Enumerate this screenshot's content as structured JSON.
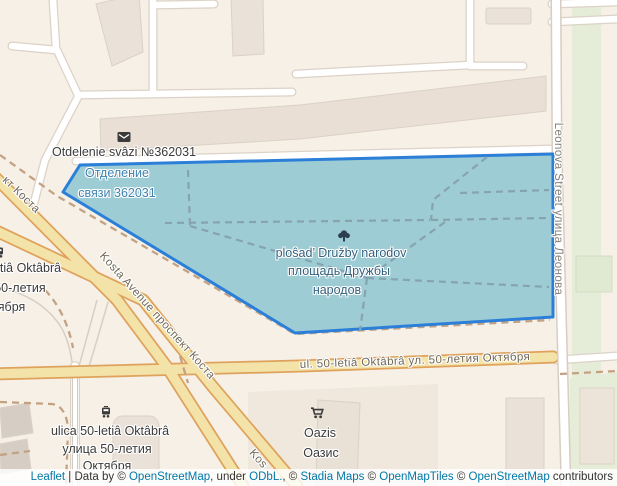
{
  "map_labels": {
    "post_office": {
      "latin": "Otdelenie svâzi №362031",
      "cyr_line1": "Отделение",
      "cyr_line2": "связи 362031"
    },
    "square": {
      "latin": "ploŝad’ Družby narodov",
      "cyr_line1": "площадь Дружбы",
      "cyr_line2": "народов"
    },
    "street_50_letiya": {
      "latin": "ulica 50-letiâ Oktâbrâ",
      "cyr_line1": "улица 50-летия",
      "cyr_line2": "Октября"
    },
    "street_50_letiya_left_cut": {
      "latin": "ulica 50-letiâ Oktâbrâ",
      "cyr_line1": "улица 50-летия",
      "cyr_line2": "Октября"
    },
    "oazis": {
      "latin": "Oazis",
      "cyr": "Оазис"
    }
  },
  "road_labels": {
    "kosta_avenue": "Kosta Avenue проспект Коста",
    "kosta_top_left_cut": "кт Коста",
    "kosta_bottom_cut": "Kos",
    "ulitsa_50_letiya": "ul. 50-letiâ Oktâbrâ ул. 50-летия Октября",
    "leonova": "Leonova Street улица Леонова"
  },
  "attribution": {
    "leaflet_link": "Leaflet",
    "data_by": " | Data by © ",
    "osm_link_1": "OpenStreetMap",
    "under": ", under ",
    "odbl_link": "ODbL.",
    "comma_c": ", © ",
    "stadia_link": "Stadia Maps",
    "c2": " © ",
    "openmaptiles_link": "OpenMapTiles",
    "c3": " © ",
    "osm_link_2": "OpenStreetMap",
    "contributors": " contributors"
  },
  "colors": {
    "selected_area_fill": "#99c9d3",
    "selected_area_border": "#2b7fd8",
    "attribution_link": "#0078a8",
    "background": "#f7f0e6"
  }
}
